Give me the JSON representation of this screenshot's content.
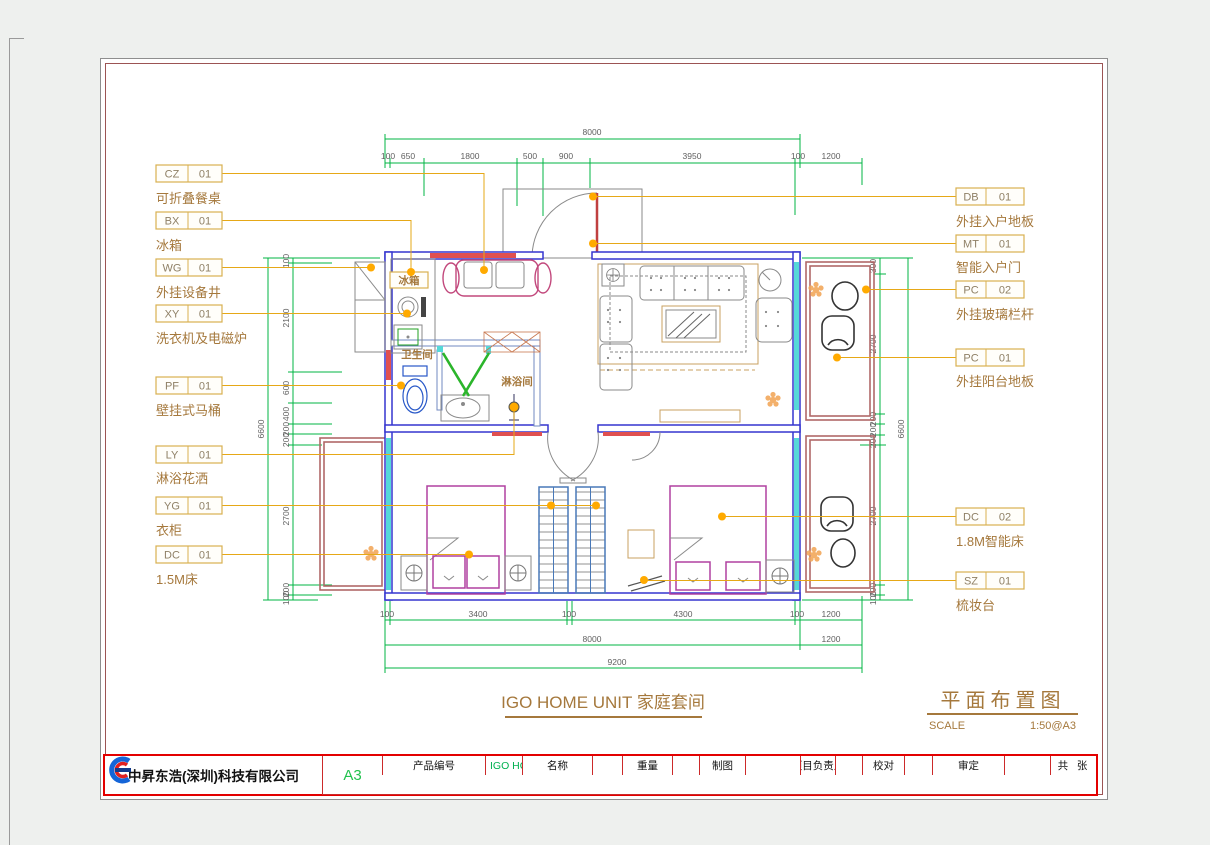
{
  "titles": {
    "plan_caption": "IGO HOME UNIT 家庭套间",
    "drawing_title": "平面布置图",
    "scale_label": "SCALE",
    "scale_value": "1:50@A3"
  },
  "room_labels": {
    "fridge": "冰箱",
    "bathroom": "卫生间",
    "shower": "淋浴间"
  },
  "annotations": {
    "left": [
      {
        "code": "CZ",
        "num": "01",
        "desc": "可折叠餐桌"
      },
      {
        "code": "BX",
        "num": "01",
        "desc": "冰箱"
      },
      {
        "code": "WG",
        "num": "01",
        "desc": "外挂设备井"
      },
      {
        "code": "XY",
        "num": "01",
        "desc": "洗衣机及电磁炉"
      },
      {
        "code": "PF",
        "num": "01",
        "desc": "壁挂式马桶"
      },
      {
        "code": "LY",
        "num": "01",
        "desc": "淋浴花洒"
      },
      {
        "code": "YG",
        "num": "01",
        "desc": "衣柜"
      },
      {
        "code": "DC",
        "num": "01",
        "desc": "1.5M床"
      }
    ],
    "right": [
      {
        "code": "DB",
        "num": "01",
        "desc": "外挂入户地板"
      },
      {
        "code": "MT",
        "num": "01",
        "desc": "智能入户门"
      },
      {
        "code": "PC",
        "num": "02",
        "desc": "外挂玻璃栏杆"
      },
      {
        "code": "PC",
        "num": "01",
        "desc": "外挂阳台地板"
      },
      {
        "code": "DC",
        "num": "02",
        "desc": "1.8M智能床"
      },
      {
        "code": "SZ",
        "num": "01",
        "desc": "梳妆台"
      }
    ]
  },
  "dimensions": {
    "top_overall": "8000",
    "top_chain": [
      "100",
      "650",
      "1800",
      "500",
      "900",
      "3950",
      "100",
      "1200"
    ],
    "bottom_chain": [
      "100",
      "3400",
      "100",
      "4300",
      "100",
      "1200"
    ],
    "bottom_overall_left": "8000",
    "bottom_overall_right": "1200",
    "bottom_total": "9200",
    "left_chain": [
      "100",
      "2100",
      "600",
      "400",
      "200",
      "200",
      "2700",
      "200",
      "100"
    ],
    "left_overall": "6600",
    "right_chain": [
      "300",
      "2700",
      "200",
      "200",
      "200",
      "2700",
      "200",
      "100"
    ],
    "right_overall": "6600"
  },
  "title_block": {
    "company": "中昇东浩(深圳)科技有限公司",
    "product_no_label": "产品编号",
    "product_no_value": "IGO HOME UNIT 家庭套间",
    "drawing_no_label": "图号",
    "name_label": "名称",
    "material_label": "材料",
    "weight_label": "重量",
    "scale_label": "比例",
    "scale_value": "1:50",
    "drafting_label": "制图",
    "design_label": "设计",
    "pm_label": "项目负责人",
    "standardization_label": "标准化",
    "proofread_label": "校对",
    "review_label": "审核",
    "approval_label": "审定",
    "date_label": "日期",
    "date_value": "2025.03.06",
    "total_sheets_label": "共   张",
    "sheet_no_label": "第   张",
    "paper_size": "A3"
  },
  "colors": {
    "wall_blue": "#3535cf",
    "dimension_green": "#00b443",
    "leader_gold": "#e6a817",
    "annotation_brown": "#a5783c",
    "title_block_red": "#e30000",
    "value_green": "#00b050",
    "balcony_maroon": "#b06868",
    "glass_cyan": "#55d8d8"
  }
}
